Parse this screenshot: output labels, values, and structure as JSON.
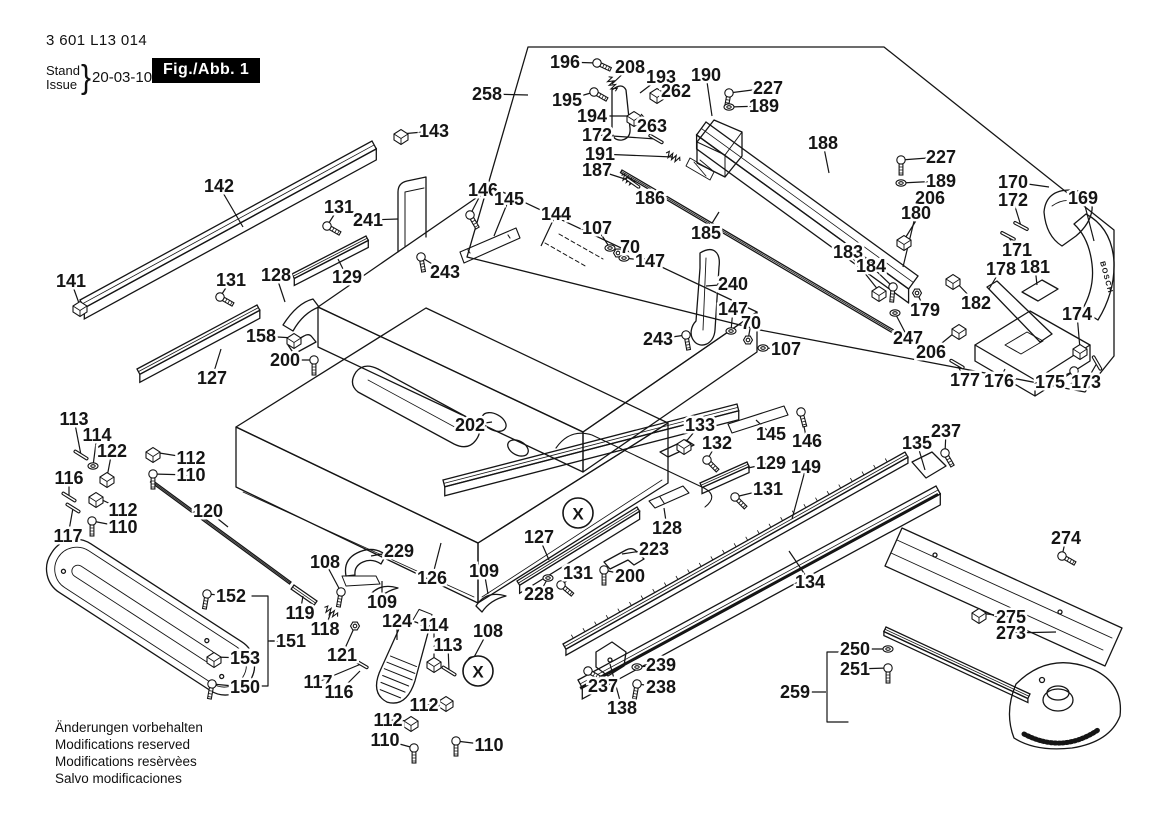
{
  "header": {
    "part_number": "3 601 L13 014",
    "stand": "Stand",
    "issue": "Issue",
    "brace": "}",
    "date": "20-03-10",
    "figure": "Fig./Abb. 1"
  },
  "footer_lines": [
    "Änderungen vorbehalten",
    "Modifications reserved",
    "Modifications resèrvèes",
    "Salvo modificaciones"
  ],
  "branding_text": "BOSCH",
  "colors": {
    "ink": "#151515",
    "paper": "#ffffff"
  },
  "callouts": [
    {
      "t": "X",
      "x": 578,
      "y": 513
    },
    {
      "t": "X",
      "x": 478,
      "y": 671
    }
  ],
  "labels": [
    {
      "t": "258",
      "x": 487,
      "y": 94,
      "lx": 528,
      "ly": 95
    },
    {
      "t": "196",
      "x": 565,
      "y": 62,
      "lx": 597,
      "ly": 63,
      "g": "s",
      "ga": 25
    },
    {
      "t": "208",
      "x": 630,
      "y": 67,
      "lx": 612,
      "ly": 84,
      "g": "k",
      "ga": 65
    },
    {
      "t": "193",
      "x": 661,
      "y": 77,
      "lx": 640,
      "ly": 93
    },
    {
      "t": "190",
      "x": 706,
      "y": 75,
      "lx": 712,
      "ly": 116
    },
    {
      "t": "227",
      "x": 768,
      "y": 88,
      "lx": 729,
      "ly": 93,
      "g": "s",
      "ga": 100
    },
    {
      "t": "189",
      "x": 764,
      "y": 106,
      "lx": 729,
      "ly": 107,
      "g": "w"
    },
    {
      "t": "195",
      "x": 567,
      "y": 100,
      "lx": 594,
      "ly": 92,
      "g": "s",
      "ga": 30
    },
    {
      "t": "262",
      "x": 676,
      "y": 91,
      "lx": 657,
      "ly": 93,
      "g": "b"
    },
    {
      "t": "194",
      "x": 592,
      "y": 116,
      "lx": 634,
      "ly": 116,
      "g": "b"
    },
    {
      "t": "263",
      "x": 652,
      "y": 126,
      "lx": 641,
      "ly": 114
    },
    {
      "t": "172",
      "x": 597,
      "y": 135,
      "lx": 656,
      "ly": 139,
      "g": "p",
      "ga": 30
    },
    {
      "t": "191",
      "x": 600,
      "y": 154,
      "lx": 673,
      "ly": 157,
      "g": "k",
      "ga": 30
    },
    {
      "t": "187",
      "x": 597,
      "y": 170,
      "lx": 628,
      "ly": 180,
      "g": "k",
      "ga": 35
    },
    {
      "t": "186",
      "x": 650,
      "y": 198,
      "lx": 633,
      "ly": 183,
      "g": "p",
      "ga": 35
    },
    {
      "t": "185",
      "x": 706,
      "y": 233,
      "lx": 719,
      "ly": 212
    },
    {
      "t": "188",
      "x": 823,
      "y": 143,
      "lx": 829,
      "ly": 173
    },
    {
      "t": "227",
      "x": 941,
      "y": 157,
      "lx": 901,
      "ly": 160,
      "g": "s",
      "ga": 90
    },
    {
      "t": "189",
      "x": 941,
      "y": 181,
      "lx": 901,
      "ly": 183,
      "g": "w"
    },
    {
      "t": "206",
      "x": 930,
      "y": 198,
      "lx": 904,
      "ly": 240,
      "g": "b"
    },
    {
      "t": "180",
      "x": 916,
      "y": 213,
      "lx": 903,
      "ly": 267
    },
    {
      "t": "170",
      "x": 1013,
      "y": 182,
      "lx": 1049,
      "ly": 187
    },
    {
      "t": "172",
      "x": 1013,
      "y": 200,
      "lx": 1021,
      "ly": 226,
      "g": "p",
      "ga": 28
    },
    {
      "t": "169",
      "x": 1083,
      "y": 198,
      "lx": 1094,
      "ly": 241
    },
    {
      "t": "171",
      "x": 1017,
      "y": 250,
      "lx": 1008,
      "ly": 236,
      "g": "p",
      "ga": 28
    },
    {
      "t": "183",
      "x": 848,
      "y": 252,
      "lx": 879,
      "ly": 291,
      "g": "b"
    },
    {
      "t": "184",
      "x": 871,
      "y": 266,
      "lx": 893,
      "ly": 287,
      "g": "s",
      "ga": 95
    },
    {
      "t": "178",
      "x": 1001,
      "y": 269,
      "lx": 989,
      "ly": 289
    },
    {
      "t": "181",
      "x": 1035,
      "y": 267,
      "lx": 1037,
      "ly": 285
    },
    {
      "t": "182",
      "x": 976,
      "y": 303,
      "lx": 953,
      "ly": 279,
      "g": "b"
    },
    {
      "t": "179",
      "x": 925,
      "y": 310,
      "lx": 917,
      "ly": 293,
      "g": "n"
    },
    {
      "t": "247",
      "x": 908,
      "y": 338,
      "lx": 895,
      "ly": 313,
      "g": "w"
    },
    {
      "t": "206",
      "x": 931,
      "y": 352,
      "lx": 959,
      "ly": 329,
      "g": "b"
    },
    {
      "t": "177",
      "x": 965,
      "y": 380,
      "lx": 957,
      "ly": 364,
      "g": "p",
      "ga": 30
    },
    {
      "t": "176",
      "x": 999,
      "y": 381,
      "lx": 1005,
      "ly": 369
    },
    {
      "t": "175",
      "x": 1050,
      "y": 382,
      "lx": 1074,
      "ly": 371,
      "g": "s",
      "ga": 95
    },
    {
      "t": "173",
      "x": 1086,
      "y": 382,
      "lx": 1097,
      "ly": 363,
      "g": "p",
      "ga": 60
    },
    {
      "t": "174",
      "x": 1077,
      "y": 314,
      "lx": 1080,
      "ly": 349,
      "g": "b"
    },
    {
      "t": "143",
      "x": 434,
      "y": 131,
      "lx": 401,
      "ly": 134,
      "g": "b"
    },
    {
      "t": "142",
      "x": 219,
      "y": 186,
      "lx": 243,
      "ly": 227
    },
    {
      "t": "131",
      "x": 339,
      "y": 207,
      "lx": 327,
      "ly": 226,
      "g": "s",
      "ga": 30
    },
    {
      "t": "241",
      "x": 368,
      "y": 220,
      "lx": 398,
      "ly": 219
    },
    {
      "t": "146",
      "x": 483,
      "y": 190,
      "lx": 470,
      "ly": 215,
      "g": "s",
      "ga": 60
    },
    {
      "t": "145",
      "x": 509,
      "y": 199,
      "lx": 494,
      "ly": 236
    },
    {
      "t": "144",
      "x": 556,
      "y": 214,
      "lx": 541,
      "ly": 246
    },
    {
      "t": "107",
      "x": 597,
      "y": 228,
      "lx": 610,
      "ly": 248,
      "g": "w"
    },
    {
      "t": "70",
      "x": 630,
      "y": 247,
      "lx": 618,
      "ly": 253,
      "g": "n"
    },
    {
      "t": "147",
      "x": 650,
      "y": 261,
      "lx": 624,
      "ly": 258,
      "g": "w"
    },
    {
      "t": "243",
      "x": 445,
      "y": 272,
      "lx": 421,
      "ly": 257,
      "g": "s",
      "ga": 80
    },
    {
      "t": "129",
      "x": 347,
      "y": 277,
      "lx": 338,
      "ly": 259
    },
    {
      "t": "128",
      "x": 276,
      "y": 275,
      "lx": 285,
      "ly": 302
    },
    {
      "t": "131",
      "x": 231,
      "y": 280,
      "lx": 220,
      "ly": 297,
      "g": "s",
      "ga": 30
    },
    {
      "t": "141",
      "x": 71,
      "y": 281,
      "lx": 80,
      "ly": 306,
      "g": "b"
    },
    {
      "t": "158",
      "x": 261,
      "y": 336,
      "lx": 294,
      "ly": 338,
      "g": "b"
    },
    {
      "t": "200",
      "x": 285,
      "y": 360,
      "lx": 314,
      "ly": 360,
      "g": "s",
      "ga": 90
    },
    {
      "t": "127",
      "x": 212,
      "y": 378,
      "lx": 221,
      "ly": 349
    },
    {
      "t": "240",
      "x": 733,
      "y": 284,
      "lx": 706,
      "ly": 286
    },
    {
      "t": "147",
      "x": 733,
      "y": 309,
      "lx": 731,
      "ly": 331,
      "g": "w"
    },
    {
      "t": "70",
      "x": 751,
      "y": 323,
      "lx": 748,
      "ly": 340,
      "g": "n"
    },
    {
      "t": "107",
      "x": 786,
      "y": 349,
      "lx": 763,
      "ly": 348,
      "g": "w"
    },
    {
      "t": "243",
      "x": 658,
      "y": 339,
      "lx": 686,
      "ly": 335,
      "g": "s",
      "ga": 80
    },
    {
      "t": "202",
      "x": 470,
      "y": 425,
      "lx": 492,
      "ly": 422
    },
    {
      "t": "133",
      "x": 700,
      "y": 425,
      "lx": 684,
      "ly": 444,
      "g": "b"
    },
    {
      "t": "132",
      "x": 717,
      "y": 443,
      "lx": 707,
      "ly": 460,
      "g": "s",
      "ga": 45
    },
    {
      "t": "129",
      "x": 771,
      "y": 463,
      "lx": 748,
      "ly": 468
    },
    {
      "t": "131",
      "x": 768,
      "y": 489,
      "lx": 735,
      "ly": 497,
      "g": "s",
      "ga": 45
    },
    {
      "t": "149",
      "x": 806,
      "y": 467,
      "lx": 792,
      "ly": 519
    },
    {
      "t": "145",
      "x": 771,
      "y": 434,
      "lx": 756,
      "ly": 420
    },
    {
      "t": "146",
      "x": 807,
      "y": 441,
      "lx": 801,
      "ly": 412,
      "g": "s",
      "ga": 75
    },
    {
      "t": "135",
      "x": 917,
      "y": 443,
      "lx": 925,
      "ly": 470
    },
    {
      "t": "237",
      "x": 946,
      "y": 431,
      "lx": 945,
      "ly": 453,
      "g": "s",
      "ga": 60
    },
    {
      "t": "113",
      "x": 74,
      "y": 419,
      "lx": 81,
      "ly": 455,
      "g": "p",
      "ga": 32
    },
    {
      "t": "114",
      "x": 97,
      "y": 435,
      "lx": 93,
      "ly": 466,
      "g": "w"
    },
    {
      "t": "122",
      "x": 112,
      "y": 451,
      "lx": 107,
      "ly": 477,
      "g": "b"
    },
    {
      "t": "112",
      "x": 191,
      "y": 458,
      "lx": 153,
      "ly": 452,
      "g": "b"
    },
    {
      "t": "110",
      "x": 191,
      "y": 475,
      "lx": 153,
      "ly": 474,
      "g": "s",
      "ga": 90
    },
    {
      "t": "116",
      "x": 69,
      "y": 478,
      "lx": 69,
      "ly": 497,
      "g": "p",
      "ga": 32
    },
    {
      "t": "112",
      "x": 123,
      "y": 510,
      "lx": 96,
      "ly": 497,
      "g": "b"
    },
    {
      "t": "110",
      "x": 123,
      "y": 527,
      "lx": 92,
      "ly": 521,
      "g": "s",
      "ga": 90
    },
    {
      "t": "117",
      "x": 68,
      "y": 536,
      "lx": 73,
      "ly": 508,
      "g": "p",
      "ga": 32
    },
    {
      "t": "120",
      "x": 208,
      "y": 511,
      "lx": 228,
      "ly": 527
    },
    {
      "t": "108",
      "x": 325,
      "y": 562,
      "lx": 341,
      "ly": 592,
      "g": "s",
      "ga": 100
    },
    {
      "t": "229",
      "x": 399,
      "y": 551,
      "lx": 371,
      "ly": 556
    },
    {
      "t": "109",
      "x": 382,
      "y": 602,
      "lx": 382,
      "ly": 581
    },
    {
      "t": "126",
      "x": 432,
      "y": 578,
      "lx": 441,
      "ly": 543
    },
    {
      "t": "127",
      "x": 539,
      "y": 537,
      "lx": 549,
      "ly": 560
    },
    {
      "t": "131",
      "x": 578,
      "y": 573,
      "lx": 561,
      "ly": 585,
      "g": "s",
      "ga": 40
    },
    {
      "t": "200",
      "x": 630,
      "y": 576,
      "lx": 604,
      "ly": 570,
      "g": "s",
      "ga": 90
    },
    {
      "t": "223",
      "x": 654,
      "y": 549,
      "lx": 622,
      "ly": 554
    },
    {
      "t": "228",
      "x": 539,
      "y": 594,
      "lx": 548,
      "ly": 578,
      "g": "w"
    },
    {
      "t": "109",
      "x": 484,
      "y": 571,
      "lx": 488,
      "ly": 594
    },
    {
      "t": "108",
      "x": 488,
      "y": 631,
      "lx": 472,
      "ly": 661,
      "g": "s",
      "ga": 100
    },
    {
      "t": "128",
      "x": 667,
      "y": 528,
      "lx": 664,
      "ly": 508
    },
    {
      "t": "152",
      "x": 231,
      "y": 596,
      "lx": 207,
      "ly": 594,
      "g": "s",
      "ga": 100
    },
    {
      "t": "151",
      "x": 291,
      "y": 641,
      "lx": 270,
      "ly": 641
    },
    {
      "t": "153",
      "x": 245,
      "y": 658,
      "lx": 214,
      "ly": 657,
      "g": "b"
    },
    {
      "t": "150",
      "x": 245,
      "y": 687,
      "lx": 212,
      "ly": 684,
      "g": "s",
      "ga": 100
    },
    {
      "t": "119",
      "x": 300,
      "y": 613,
      "lx": 303,
      "ly": 596
    },
    {
      "t": "118",
      "x": 325,
      "y": 629,
      "lx": 331,
      "ly": 612,
      "g": "k",
      "ga": 35
    },
    {
      "t": "121",
      "x": 342,
      "y": 655,
      "lx": 355,
      "ly": 626,
      "g": "n"
    },
    {
      "t": "124",
      "x": 397,
      "y": 621,
      "lx": 397,
      "ly": 640
    },
    {
      "t": "114",
      "x": 434,
      "y": 625,
      "lx": 434,
      "ly": 662,
      "g": "b"
    },
    {
      "t": "113",
      "x": 448,
      "y": 645,
      "lx": 449,
      "ly": 671,
      "g": "p",
      "ga": 32
    },
    {
      "t": "117",
      "x": 318,
      "y": 682,
      "lx": 361,
      "ly": 664,
      "g": "p",
      "ga": 30
    },
    {
      "t": "116",
      "x": 339,
      "y": 692,
      "lx": 360,
      "ly": 671
    },
    {
      "t": "112",
      "x": 388,
      "y": 720,
      "lx": 411,
      "ly": 721,
      "g": "b"
    },
    {
      "t": "110",
      "x": 385,
      "y": 740,
      "lx": 414,
      "ly": 748,
      "g": "s",
      "ga": 90
    },
    {
      "t": "112",
      "x": 424,
      "y": 705,
      "lx": 446,
      "ly": 701,
      "g": "b"
    },
    {
      "t": "110",
      "x": 489,
      "y": 745,
      "lx": 456,
      "ly": 741,
      "g": "s",
      "ga": 90
    },
    {
      "t": "237",
      "x": 603,
      "y": 686,
      "lx": 588,
      "ly": 671,
      "g": "s",
      "ga": 30
    },
    {
      "t": "239",
      "x": 661,
      "y": 665,
      "lx": 637,
      "ly": 667,
      "g": "w"
    },
    {
      "t": "238",
      "x": 661,
      "y": 687,
      "lx": 637,
      "ly": 684,
      "g": "s",
      "ga": 100
    },
    {
      "t": "138",
      "x": 622,
      "y": 708,
      "lx": 610,
      "ly": 664
    },
    {
      "t": "134",
      "x": 810,
      "y": 582,
      "lx": 789,
      "ly": 551
    },
    {
      "t": "274",
      "x": 1066,
      "y": 538,
      "lx": 1062,
      "ly": 556,
      "g": "s",
      "ga": 30
    },
    {
      "t": "275",
      "x": 1011,
      "y": 617,
      "lx": 979,
      "ly": 613,
      "g": "b"
    },
    {
      "t": "273",
      "x": 1011,
      "y": 633,
      "lx": 1056,
      "ly": 632
    },
    {
      "t": "250",
      "x": 855,
      "y": 649,
      "lx": 888,
      "ly": 649,
      "g": "w"
    },
    {
      "t": "251",
      "x": 855,
      "y": 669,
      "lx": 888,
      "ly": 668,
      "g": "s",
      "ga": 90
    },
    {
      "t": "259",
      "x": 795,
      "y": 692,
      "lx": 826,
      "ly": 692
    }
  ]
}
